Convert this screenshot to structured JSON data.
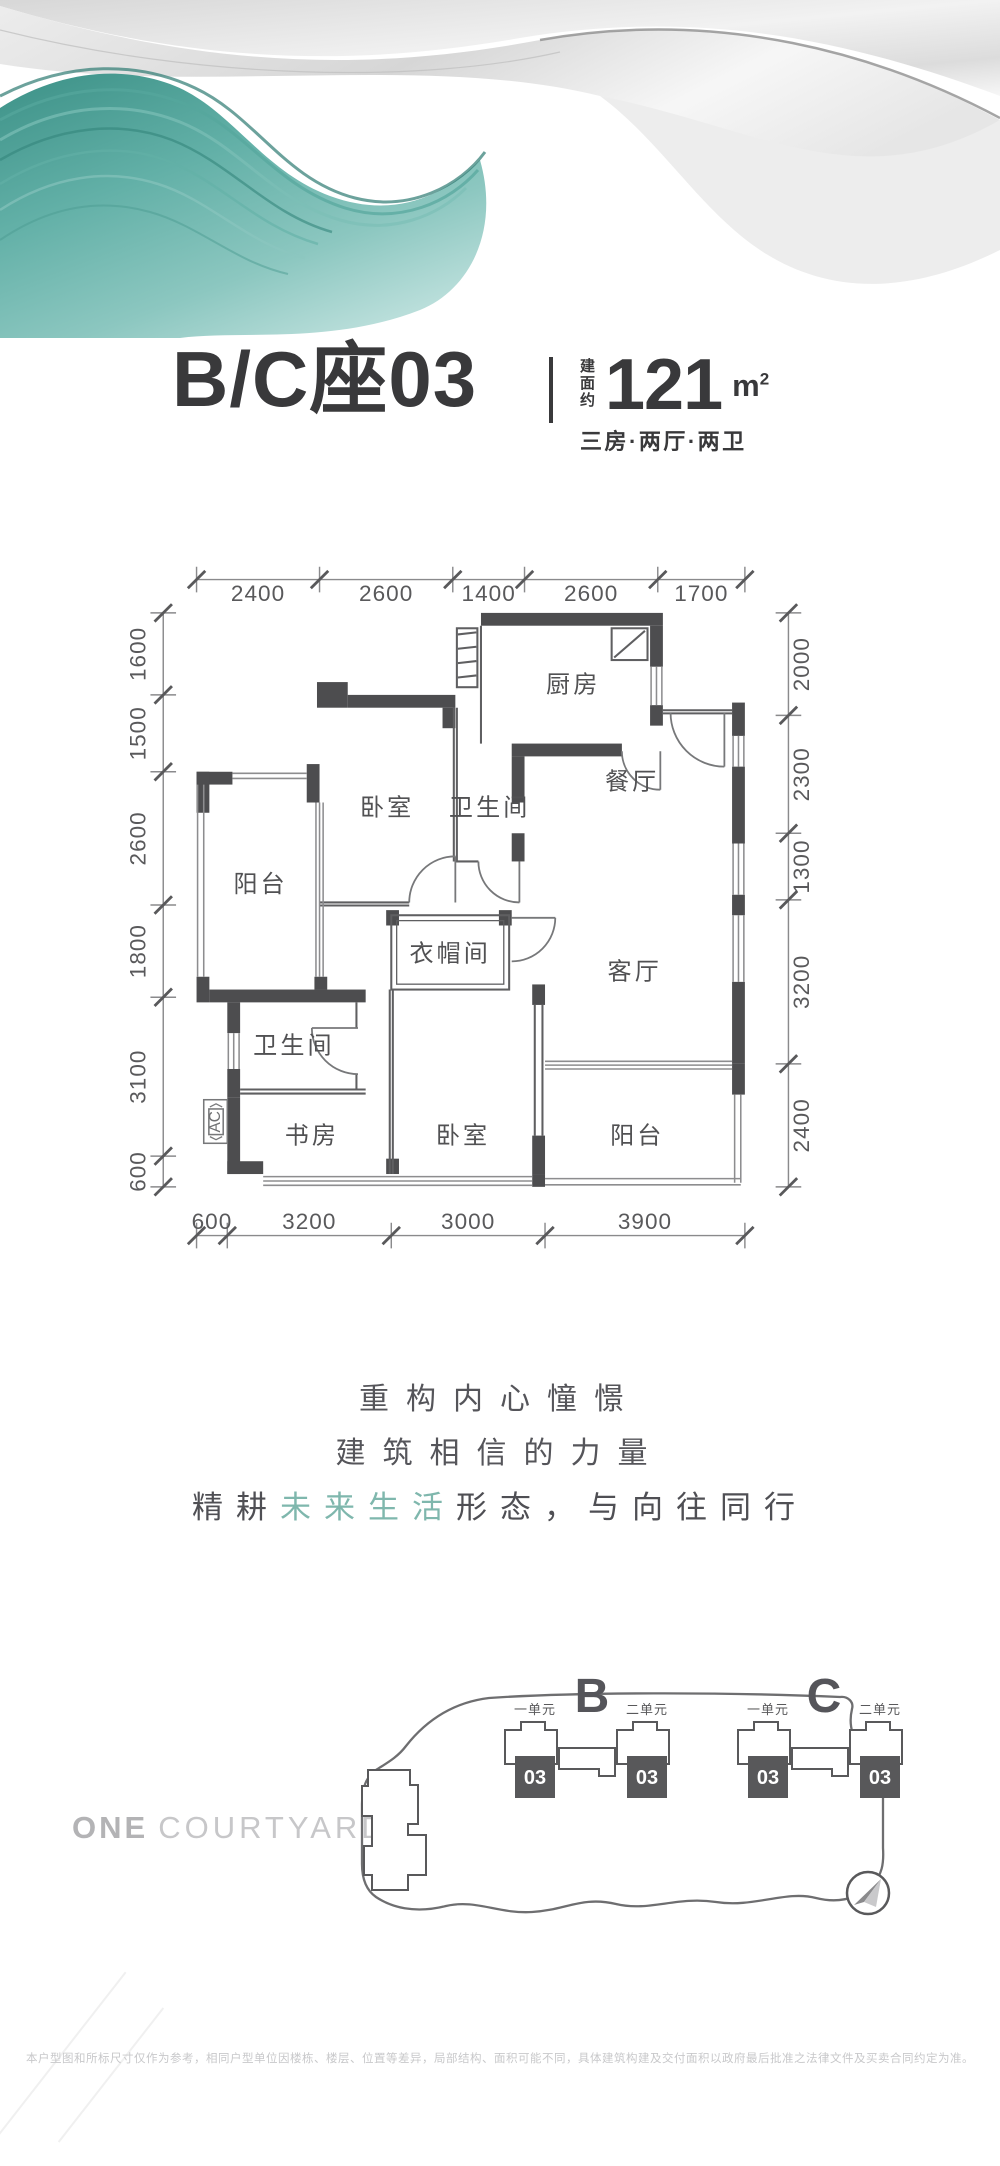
{
  "header": {
    "title": "B/C座03",
    "area_prefix": "建面约",
    "area_value": "121",
    "area_unit_base": "m",
    "area_unit_sup": "2",
    "layout_desc": "三房·两厅·两卫"
  },
  "floorplan": {
    "rooms": {
      "kitchen": "厨房",
      "dining": "餐厅",
      "bedroom_top": "卧室",
      "bath_top": "卫生间",
      "balcony_left": "阳台",
      "bath_left": "卫生间",
      "cloakroom": "衣帽间",
      "living": "客厅",
      "study": "书房",
      "bedroom_bottom": "卧室",
      "balcony_bottom": "阳台",
      "ac": "AC"
    },
    "dims": {
      "top": [
        "2400",
        "2600",
        "1400",
        "2600",
        "1700"
      ],
      "bottom": [
        "600",
        "3200",
        "3000",
        "3900"
      ],
      "left": [
        "1600",
        "1500",
        "2600",
        "1800",
        "3100",
        "600"
      ],
      "right": [
        "2000",
        "2300",
        "1300",
        "3200",
        "2400"
      ]
    }
  },
  "slogan": {
    "line1": "重构内心憧憬",
    "line2": "建筑相信的力量",
    "line3_pre": "精耕",
    "line3_highlight": "未来生活",
    "line3_post": "形态，与向往同行"
  },
  "siteplan": {
    "logo_bold": "ONE",
    "logo_light": "COURTYARD",
    "building_b": "B",
    "building_c": "C",
    "unit_1": "一单元",
    "unit_2": "二单元",
    "unit_no": "03"
  },
  "footer": {
    "disclaimer": "本户型图和所标尺寸仅作为参考，相同户型单位因楼栋、楼层、位置等差异，局部结构、面积可能不同，具体建筑构建及交付面积以政府最后批准之法律文件及买卖合同约定为准。"
  },
  "colors": {
    "teal": "#5fa89e",
    "wall": "#4d4d4f",
    "accent_text": "#39393b"
  }
}
